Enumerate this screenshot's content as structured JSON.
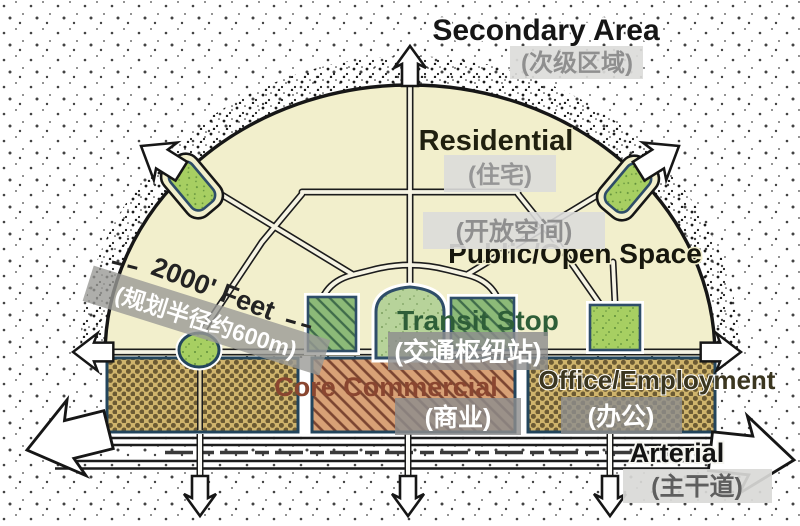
{
  "labels": {
    "secondary_area": {
      "en": "Secondary Area",
      "zh": "(次级区域)"
    },
    "residential": {
      "en": "Residential",
      "zh": "(住宅)"
    },
    "public_open_space": {
      "en": "Public/Open Space",
      "zh": "(开放空间)"
    },
    "transit_stop": {
      "en": "Transit Stop",
      "zh": "(交通枢纽站)"
    },
    "core_commercial": {
      "en": "Core Commercial",
      "zh": "(商业)"
    },
    "office_employment": {
      "en": "Office/Employment",
      "zh": "(办公)"
    },
    "arterial": {
      "en": "Arterial",
      "zh": "(主干道)"
    },
    "radius_annotation": {
      "en": "2000' Feet",
      "zh": "(规划半径约600m)"
    }
  },
  "colors": {
    "area_cream": "#f2efcc",
    "dome_green": "#b7d39a",
    "park_green": "#a7cf62",
    "hatch_green": "#8cba78",
    "khaki_block": "#cfb46c",
    "commercial_salmon": "#d8a176",
    "navy_outline": "#2e4d68",
    "ink": "#1c1c1c",
    "transit_text_green": "#2e5e38",
    "commercial_text_brown": "#8a4630",
    "office_text_olive": "#3b3620",
    "overlay_light_box": "#dcdcda",
    "overlay_light_text": "#8f8f8f",
    "overlay_dark_box": "#8d8d8d",
    "overlay_dark_text": "#ffffff"
  }
}
